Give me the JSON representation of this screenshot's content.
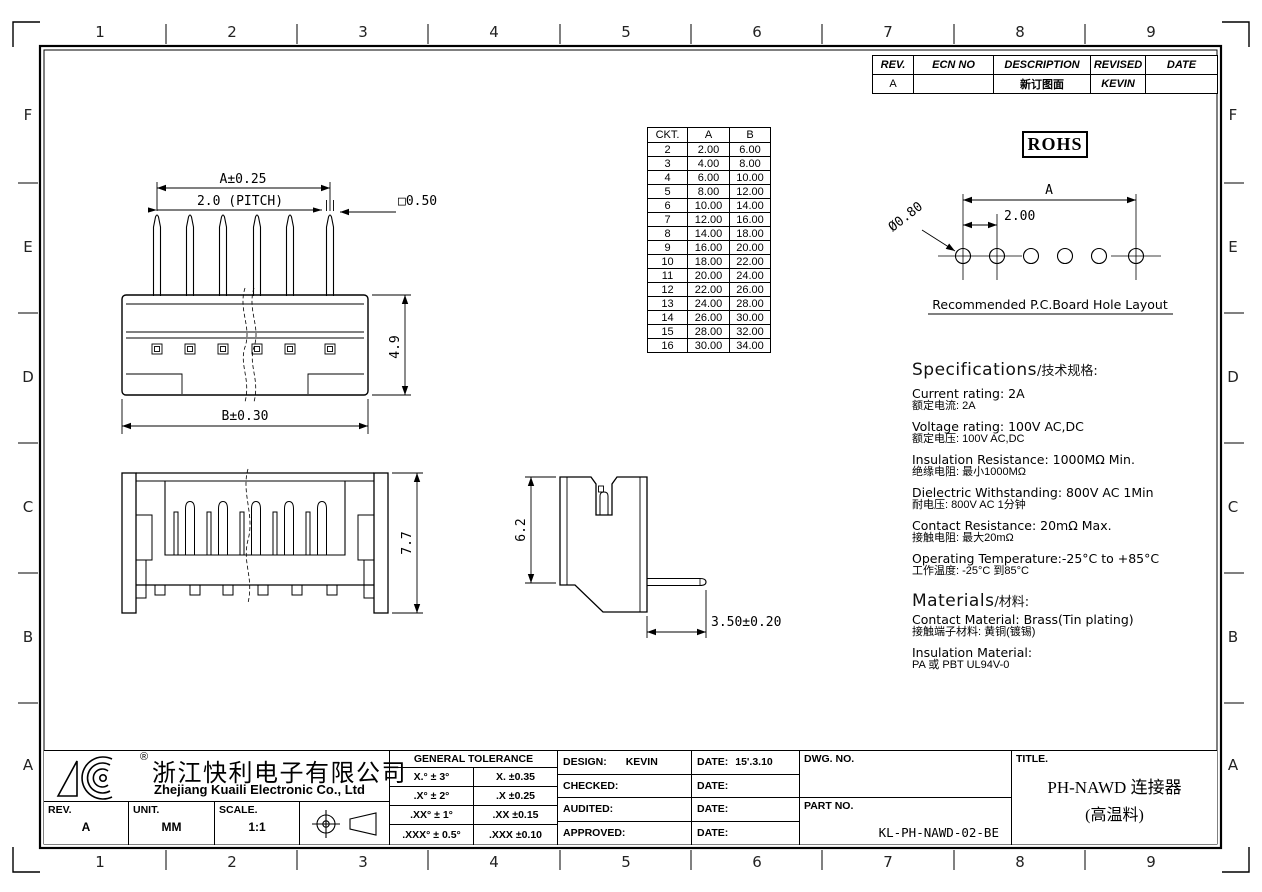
{
  "sheet": {
    "cols": [
      "1",
      "2",
      "3",
      "4",
      "5",
      "6",
      "7",
      "8",
      "9"
    ],
    "rows": [
      "F",
      "E",
      "D",
      "C",
      "B",
      "A"
    ]
  },
  "revision_table": {
    "headers": [
      "REV.",
      "ECN NO",
      "DESCRIPTION",
      "REVISED",
      "DATE"
    ],
    "rows": [
      [
        "A",
        "",
        "新订图面",
        "KEVIN",
        ""
      ]
    ]
  },
  "rohs_label": "ROHS",
  "ckt_table": {
    "headers": [
      "CKT.",
      "A",
      "B"
    ],
    "rows": [
      [
        "2",
        "2.00",
        "6.00"
      ],
      [
        "3",
        "4.00",
        "8.00"
      ],
      [
        "4",
        "6.00",
        "10.00"
      ],
      [
        "5",
        "8.00",
        "12.00"
      ],
      [
        "6",
        "10.00",
        "14.00"
      ],
      [
        "7",
        "12.00",
        "16.00"
      ],
      [
        "8",
        "14.00",
        "18.00"
      ],
      [
        "9",
        "16.00",
        "20.00"
      ],
      [
        "10",
        "18.00",
        "22.00"
      ],
      [
        "11",
        "20.00",
        "24.00"
      ],
      [
        "12",
        "22.00",
        "26.00"
      ],
      [
        "13",
        "24.00",
        "28.00"
      ],
      [
        "14",
        "26.00",
        "30.00"
      ],
      [
        "15",
        "28.00",
        "32.00"
      ],
      [
        "16",
        "30.00",
        "34.00"
      ]
    ]
  },
  "hole_layout": {
    "dia_label": "Ø0.80",
    "span_label": "A",
    "pitch_label": "2.00",
    "caption": "Recommended  P.C.Board Hole  Layout"
  },
  "front_view": {
    "dim_span": "A±0.25",
    "dim_pitch": "2.0 (PITCH)",
    "dim_pin": "□0.50",
    "dim_height": "4.9",
    "dim_width": "B±0.30"
  },
  "top_view": {
    "dim_height": "7.7"
  },
  "side_view": {
    "dim_height": "6.2",
    "dim_tail": "3.50±0.20"
  },
  "specs": {
    "heading_en": "Specifications",
    "heading_zh": "/技术规格:",
    "items": [
      {
        "en": "Current  rating:  2A",
        "zh": "额定电流: 2A"
      },
      {
        "en": "Voltage  rating:  100V  AC,DC",
        "zh": "额定电压: 100V AC,DC"
      },
      {
        "en": "Insulation  Resistance:  1000MΩ  Min.",
        "zh": "绝缘电阻: 最小1000MΩ"
      },
      {
        "en": "Dielectric  Withstanding:   800V AC   1Min",
        "zh": "耐电压: 800V AC  1分钟"
      },
      {
        "en": "Contact  Resistance:   20mΩ  Max.",
        "zh": "接触电阻: 最大20mΩ"
      },
      {
        "en": "Operating  Temperature:-25°C  to  +85°C",
        "zh": "工作温度: -25°C 到85°C"
      }
    ]
  },
  "materials": {
    "heading_en": "Materials",
    "heading_zh": "/材料:",
    "items": [
      {
        "en": "Contact  Material:  Brass(Tin  plating)",
        "zh": "接触端子材料: 黄铜(镀锡)"
      },
      {
        "en": "Insulation  Material:",
        "zh": "PA 或 PBT UL94V-0"
      }
    ]
  },
  "title_block": {
    "company_cn": "浙江快利电子有限公司",
    "company_en": "Zhejiang  Kuaili  Electronic  Co.,  Ltd",
    "registered_mark": "®",
    "rev_label": "REV.",
    "rev_value": "A",
    "unit_label": "UNIT.",
    "unit_value": "MM",
    "scale_label": "SCALE.",
    "scale_value": "1:1",
    "tolerance": {
      "title": "GENERAL  TOLERANCE",
      "rows": [
        [
          "X.° ± 3°",
          "X.   ±0.35"
        ],
        [
          ".X° ± 2°",
          ".X   ±0.25"
        ],
        [
          ".XX° ± 1°",
          ".XX  ±0.15"
        ],
        [
          ".XXX° ± 0.5°",
          ".XXX ±0.10"
        ]
      ]
    },
    "approval": {
      "rows": [
        {
          "label": "DESIGN:",
          "value": "KEVIN",
          "date_label": "DATE:",
          "date_value": "15'.3.10"
        },
        {
          "label": "CHECKED:",
          "value": "",
          "date_label": "DATE:",
          "date_value": ""
        },
        {
          "label": "AUDITED:",
          "value": "",
          "date_label": "DATE:",
          "date_value": ""
        },
        {
          "label": "APPROVED:",
          "value": "",
          "date_label": "DATE:",
          "date_value": ""
        }
      ]
    },
    "dwg_no_label": "DWG. NO.",
    "dwg_no_value": "",
    "part_no_label": "PART NO.",
    "part_no_value": "KL-PH-NAWD-02-BE",
    "title_label": "TITLE.",
    "title_line1": "PH-NAWD 连接器",
    "title_line2": "(高温料)"
  }
}
